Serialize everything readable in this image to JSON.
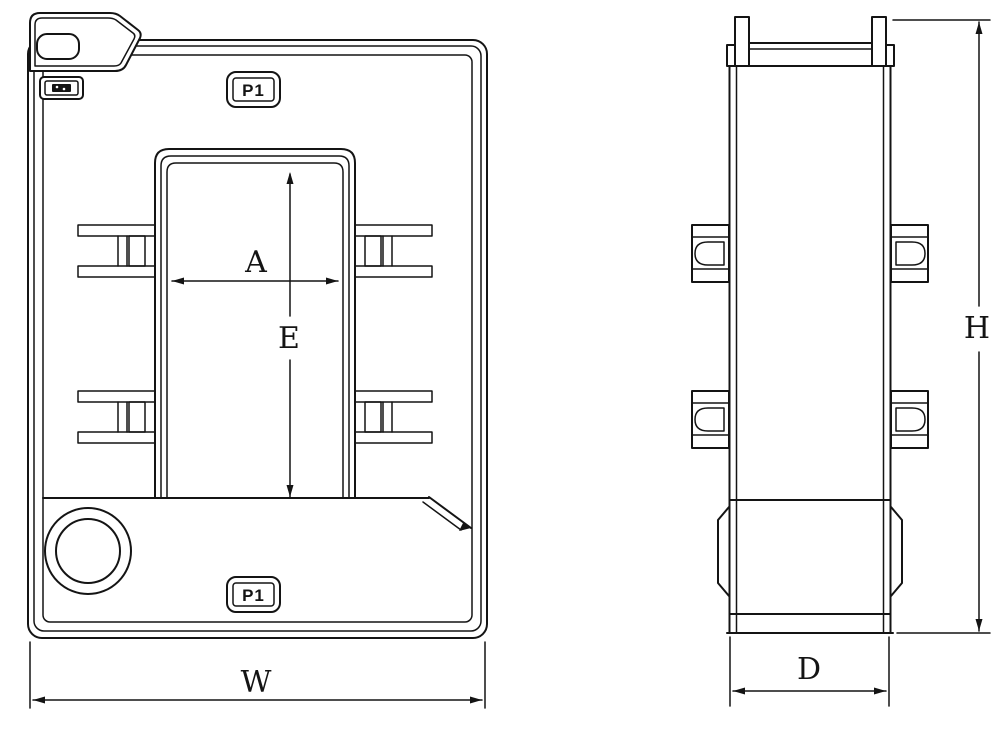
{
  "colors": {
    "ink": "#141414",
    "paper": "#ffffff"
  },
  "labels": {
    "terminal_top": "P1",
    "terminal_bottom": "P1",
    "dim_window_width": "A",
    "dim_window_height": "E",
    "dim_overall_width": "W",
    "dim_overall_height": "H",
    "dim_overall_depth": "D"
  },
  "icons": {
    "brand_mark": "filled-emblem"
  }
}
